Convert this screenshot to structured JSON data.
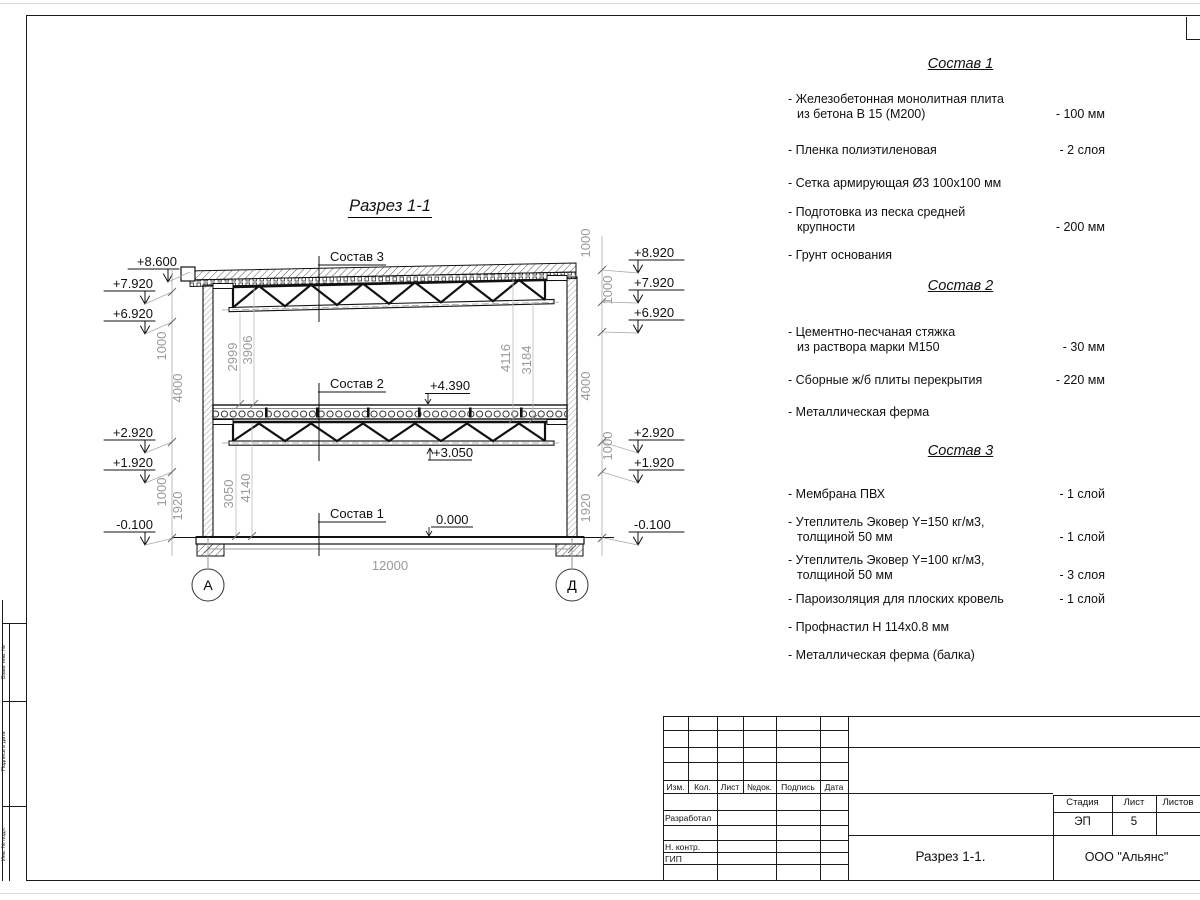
{
  "section": {
    "title": "Разрез 1-1",
    "axes": [
      "А",
      "Д"
    ],
    "marks_left": [
      "+8.600",
      "+7.920",
      "+6.920",
      "+2.920",
      "+1.920",
      "-0.100"
    ],
    "marks_right": [
      "+8.920",
      "+7.920",
      "+6.920",
      "+2.920",
      "+1.920",
      "-0.100"
    ],
    "inner_levels": {
      "floor2": "+4.390",
      "truss2": "+3.050",
      "floor1": "0.000"
    },
    "leaders": [
      "Состав 3",
      "Состав 2",
      "Состав 1"
    ],
    "dims": {
      "span": "12000",
      "left_outer": [
        "1000",
        "4000",
        "1000",
        "1920"
      ],
      "right_outer": [
        "1000",
        "1000",
        "4000",
        "1000",
        "1920"
      ],
      "upper_left": [
        "2999",
        "3906"
      ],
      "upper_right": [
        "4116",
        "3184"
      ],
      "lower_left": [
        "3050",
        "4140"
      ]
    }
  },
  "lists": [
    {
      "title": "Состав 1",
      "items": [
        {
          "name": "- Железобетонная  монолитная плита\nиз бетона В 15 (М200)",
          "value": "- 100 мм"
        },
        {
          "name": "- Пленка полиэтиленовая",
          "value": "-  2 слоя"
        },
        {
          "name": "- Сетка армирующая Ø3 100х100 мм",
          "value": ""
        },
        {
          "name": "- Подготовка из песка средней\nкрупности",
          "value": "- 200 мм"
        },
        {
          "name": "- Грунт основания",
          "value": ""
        }
      ]
    },
    {
      "title": "Состав 2",
      "items": [
        {
          "name": "- Цементно-песчаная стяжка\nиз раствора марки М150",
          "value": "- 30 мм"
        },
        {
          "name": "- Сборные ж/б плиты перекрытия",
          "value": "- 220 мм"
        },
        {
          "name": "- Металлическая ферма",
          "value": ""
        }
      ]
    },
    {
      "title": "Состав 3",
      "items": [
        {
          "name": "- Мембрана ПВХ",
          "value": "- 1 слой"
        },
        {
          "name": "- Утеплитель Эковер Y=150 кг/м3,\nтолщиной 50 мм",
          "value": "- 1 слой"
        },
        {
          "name": "- Утеплитель Эковер Y=100 кг/м3,\nтолщиной 50 мм",
          "value": "- 3 слоя"
        },
        {
          "name": "- Пароизоляция для плоских кровель",
          "value": "- 1 слой"
        },
        {
          "name": "- Профнастил Н 114х0.8 мм",
          "value": ""
        },
        {
          "name": "- Металлическая ферма (балка)",
          "value": ""
        }
      ]
    }
  ],
  "titleblock": {
    "header_cols": [
      "Изм.",
      "Кол.",
      "Лист",
      "№док.",
      "Подпись",
      "Дата"
    ],
    "roles": [
      "Разработал",
      "Н. контр.",
      "ГИП"
    ],
    "stage_label": "Стадия",
    "sheet_label": "Лист",
    "sheets_label": "Листов",
    "stage_value": "ЭП",
    "sheet_value": "5",
    "sheets_value": "",
    "doc_title": "Разрез  1-1.",
    "company": "ООО \"Альянс\""
  },
  "side_strip": {
    "labels": [
      "Взам. инв. №",
      "Подпись и дата",
      "Инв. № подл."
    ]
  }
}
